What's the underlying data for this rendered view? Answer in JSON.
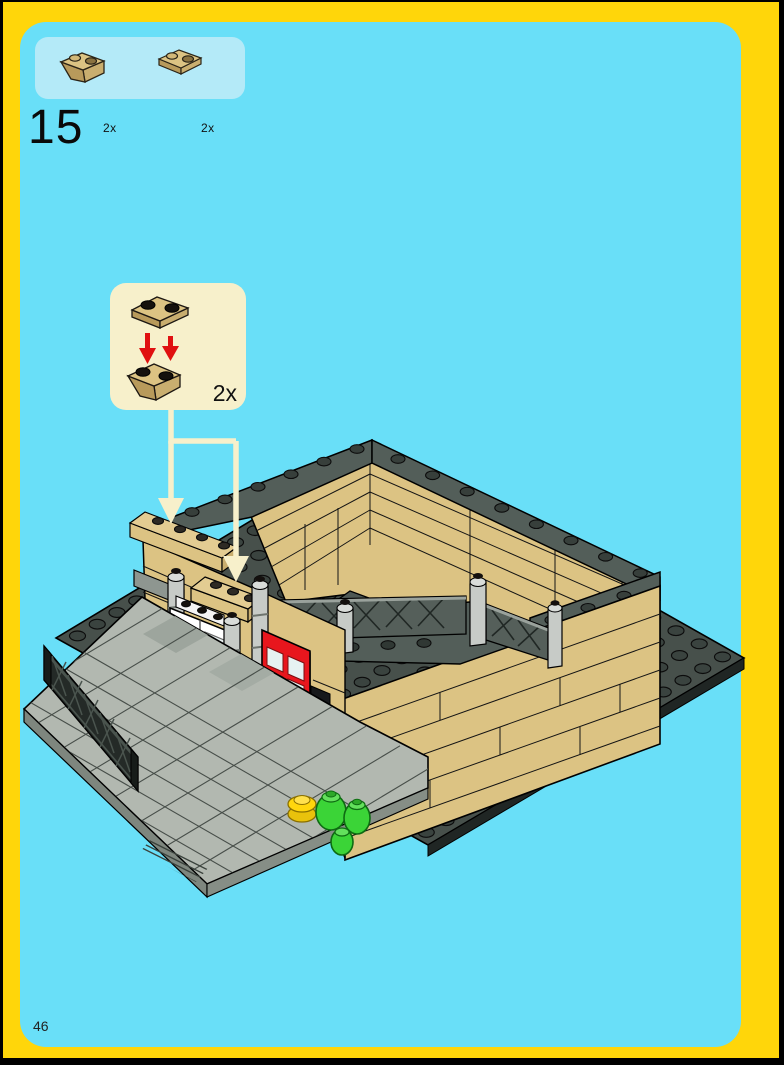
{
  "page": {
    "step_number": "15",
    "page_number": "46"
  },
  "parts_box": {
    "items": [
      {
        "qty": "2x",
        "piece": "tan-inverted-slope-brick-1x2"
      },
      {
        "qty": "2x",
        "piece": "tan-plate-1x2"
      }
    ]
  },
  "callout": {
    "qty": "2x",
    "pieces": [
      "tan-plate-1x2",
      "tan-inverted-slope-brick-1x2"
    ],
    "arrow_color": "#E01010"
  },
  "colors": {
    "background_cyan": "#69DFF8",
    "frame_yellow": "#FFD60A",
    "parts_box_blue": "#B4EAF8",
    "callout_cream": "#F7F0CB",
    "brick_tan": "#DCC383",
    "brick_tan_light": "#E3CC92",
    "brick_tan_dark": "#C9AE6F",
    "baseplate_gray": "#47504B",
    "wall_cap_gray": "#535E59",
    "sidewalk_gray": "#B2B8B0",
    "column_gray": "#C7CBC7",
    "door_red": "#E8161D",
    "door_white": "#FFFFFF",
    "plant_green": "#3BD437",
    "piece_yellow": "#FFD60D",
    "fence_black": "#242A27"
  }
}
